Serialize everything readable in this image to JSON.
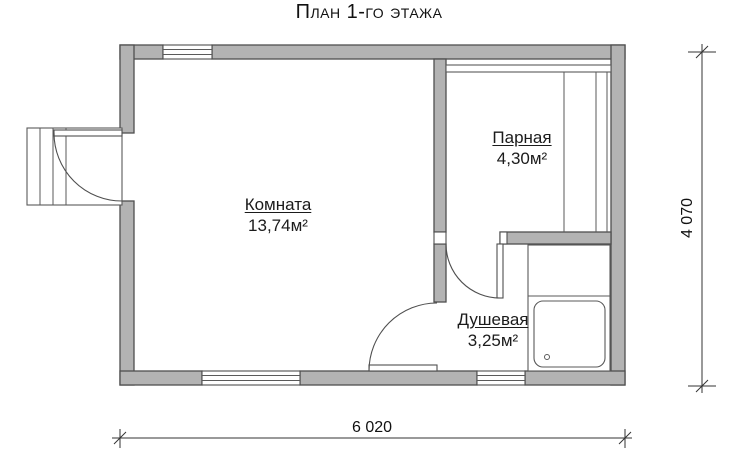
{
  "title": "План 1-го этажа",
  "rooms": [
    {
      "name": "Комната",
      "area": "13,74м²"
    },
    {
      "name": "Парная",
      "area": "4,30м²"
    },
    {
      "name": "Душевая",
      "area": "3,25м²"
    }
  ],
  "dimensions": {
    "width_mm": "6 020",
    "height_mm": "4 070"
  },
  "colors": {
    "wall_fill": "#b3b3b3",
    "wall_outline": "#4f4f4f",
    "dimension_line": "#333333",
    "background": "#ffffff",
    "text": "#111111"
  }
}
